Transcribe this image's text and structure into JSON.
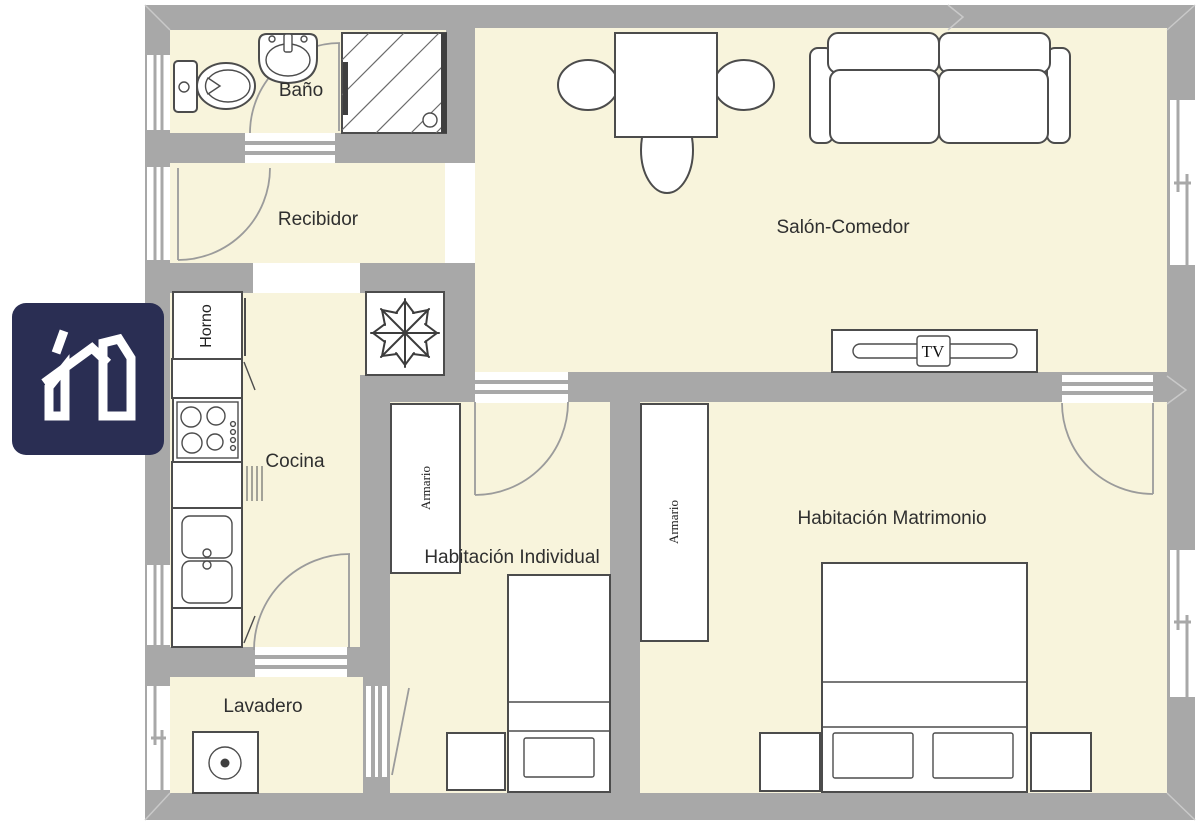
{
  "colors": {
    "wall": "#a8a8a8",
    "floor": "#f8f4dc",
    "outline": "#4c4c4c",
    "door_arc": "#9b9b9b",
    "logo_bg": "#2a2e53",
    "label_text": "#2f2f2f"
  },
  "logo": {
    "icon": "house-logo-icon"
  },
  "plan": {
    "rooms": {
      "bano": "Baño",
      "recibidor": "Recibidor",
      "salon_comedor": "Salón-Comedor",
      "cocina": "Cocina",
      "lavadero": "Lavadero",
      "habitacion_individual": "Habitación Individual",
      "habitacion_matrimonio": "Habitación Matrimonio"
    },
    "fixtures": {
      "horno": "Horno",
      "armario_individual": "Armario",
      "armario_matrimonio": "Armario",
      "tv": "TV"
    }
  }
}
